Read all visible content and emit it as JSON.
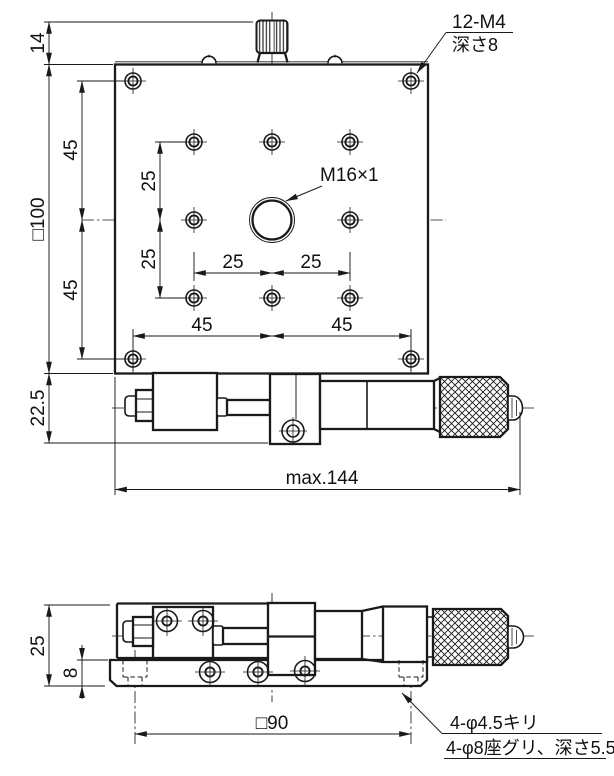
{
  "drawing": {
    "background": "#ffffff",
    "line_color": "#1a1a1a",
    "plan_view": {
      "dim_knob_height": "14",
      "dim_plate_size": "□100",
      "dim_corner_v_upper": "45",
      "dim_corner_v_lower": "45",
      "dim_grid_v_upper": "25",
      "dim_grid_v_lower": "25",
      "dim_grid_h_left": "25",
      "dim_grid_h_right": "25",
      "dim_corner_h_left": "45",
      "dim_corner_h_right": "45",
      "dim_micrometer_offset": "22.5",
      "dim_overall_max": "max.144",
      "note_tapped_holes_line1": "12-M4",
      "note_tapped_holes_line2": "深さ8",
      "note_center_thread": "M16×1"
    },
    "side_view": {
      "dim_total_height": "25",
      "dim_base_height": "8",
      "dim_mount_pitch": "□90",
      "note_mount_holes_line1": "4-φ4.5キリ",
      "note_mount_holes_line2": "4-φ8座グリ、深さ5.5"
    }
  }
}
